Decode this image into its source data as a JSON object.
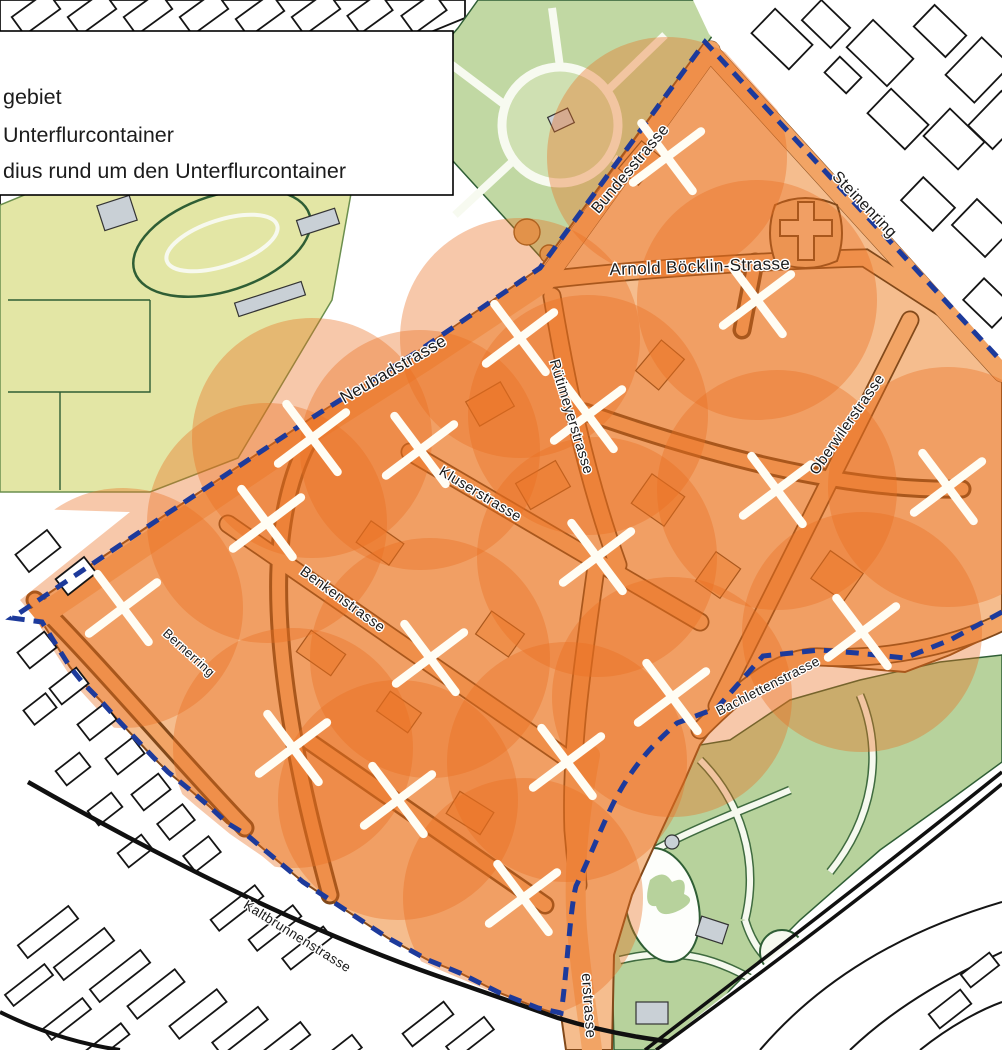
{
  "legend": {
    "items": [
      {
        "label": "gebiet"
      },
      {
        "label": "Unterflurcontainer"
      },
      {
        "label": "dius rund um den Unterflurcontainer"
      }
    ]
  },
  "map": {
    "street_labels": [
      {
        "name": "Bundesstrasse",
        "x": 634,
        "y": 172,
        "rotation": -50,
        "size": 16
      },
      {
        "name": "Steinenring",
        "x": 861,
        "y": 208,
        "rotation": 46,
        "size": 16
      },
      {
        "name": "Arnold Böcklin-Strasse",
        "x": 700,
        "y": 272,
        "rotation": -2,
        "size": 17
      },
      {
        "name": "Neubadstrasse",
        "x": 396,
        "y": 374,
        "rotation": -30,
        "size": 17
      },
      {
        "name": "Rütimeyerstrasse",
        "x": 567,
        "y": 418,
        "rotation": 73,
        "size": 14.5
      },
      {
        "name": "Kluserstrasse",
        "x": 478,
        "y": 498,
        "rotation": 31,
        "size": 14.5
      },
      {
        "name": "Oberwilerstrasse",
        "x": 851,
        "y": 427,
        "rotation": -55,
        "size": 15
      },
      {
        "name": "Benkenstrasse",
        "x": 340,
        "y": 603,
        "rotation": 36,
        "size": 14.5
      },
      {
        "name": "Bernerring",
        "x": 186,
        "y": 656,
        "rotation": 42,
        "size": 13
      },
      {
        "name": "Bachlettenstrasse",
        "x": 770,
        "y": 690,
        "rotation": -27,
        "size": 13.5
      },
      {
        "name": "Kaltbrunnenstrasse",
        "x": 295,
        "y": 940,
        "rotation": 32,
        "size": 13.5
      },
      {
        "name": "erstrasse",
        "x": 584,
        "y": 1006,
        "rotation": 86,
        "size": 15
      }
    ],
    "container_markers": [
      {
        "x": 667,
        "y": 157
      },
      {
        "x": 757,
        "y": 300
      },
      {
        "x": 520,
        "y": 338
      },
      {
        "x": 312,
        "y": 438
      },
      {
        "x": 420,
        "y": 450
      },
      {
        "x": 588,
        "y": 415
      },
      {
        "x": 777,
        "y": 490
      },
      {
        "x": 948,
        "y": 487
      },
      {
        "x": 267,
        "y": 523
      },
      {
        "x": 123,
        "y": 608
      },
      {
        "x": 597,
        "y": 557
      },
      {
        "x": 430,
        "y": 658
      },
      {
        "x": 862,
        "y": 632
      },
      {
        "x": 672,
        "y": 697
      },
      {
        "x": 293,
        "y": 748
      },
      {
        "x": 398,
        "y": 800
      },
      {
        "x": 567,
        "y": 762
      },
      {
        "x": 523,
        "y": 898
      }
    ],
    "radius_circle": {
      "radius": 120,
      "fill": "#ea6f1f",
      "opacity": 0.38
    },
    "marker_style": {
      "color": "#fffdf4",
      "arm": 30,
      "width": 8.5,
      "tilt": 8
    },
    "boundary": {
      "color": "#1d3a9b",
      "dash": "13 9",
      "width": 5
    },
    "colors": {
      "pilot_buildings": "#f5bd8e",
      "pilot_streets": "#f2a465",
      "building_outline": "#82491a",
      "park_green": "#c1d8a3",
      "zoo_green": "#b7d29c",
      "field_green": "#e3e6a5",
      "tree_green": "#a6c683",
      "gray_building": "#c9d0d6",
      "outside_outline": "#151515"
    }
  }
}
